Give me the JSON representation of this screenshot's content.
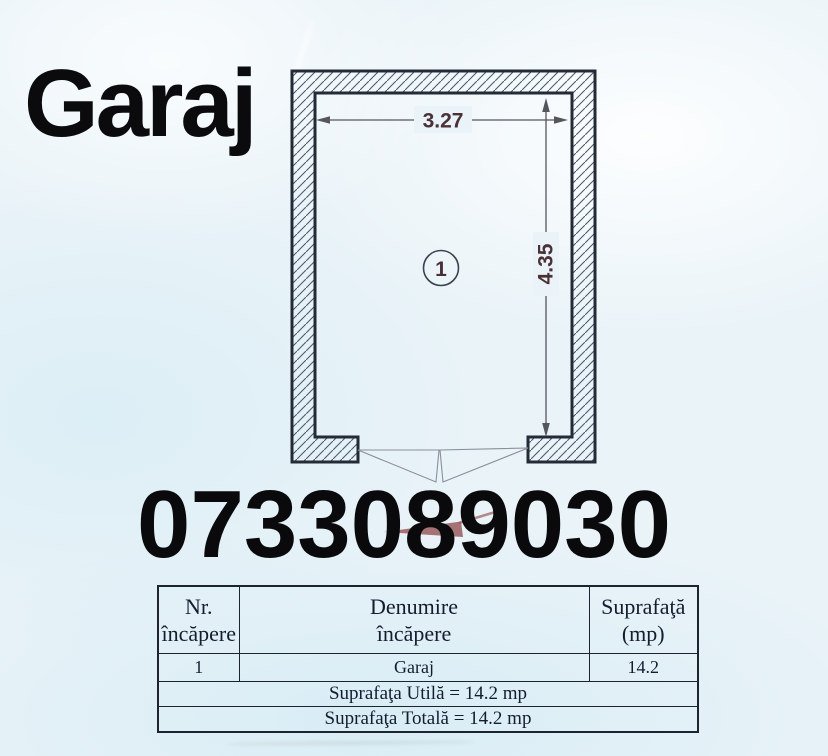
{
  "title": "Garaj",
  "phone": "0733089030",
  "plan": {
    "room_number": "1",
    "width_m": "3.27",
    "height_m": "4.35"
  },
  "table": {
    "headers": {
      "nr": "Nr.\nîncăpere",
      "denumire": "Denumire\nîncăpere",
      "suprafata": "Suprafaţă\n(mp)"
    },
    "rows": [
      {
        "nr": "1",
        "denumire": "Garaj",
        "suprafata": "14.2"
      }
    ],
    "summary_utila": "Suprafaţa Utilă = 14.2 mp",
    "summary_totala": "Suprafaţa Totală = 14.2 mp"
  },
  "colors": {
    "paper": "#e9f3f8",
    "wall_outline": "#242b36",
    "hatch_line": "#4c5a6e",
    "dimension_text": "#4b3036",
    "dimension_line": "#55565e",
    "door_line": "#8a8f99",
    "accent_red": "#995a5e",
    "ink": "#0b0b0e",
    "table_ink": "#141d30"
  }
}
